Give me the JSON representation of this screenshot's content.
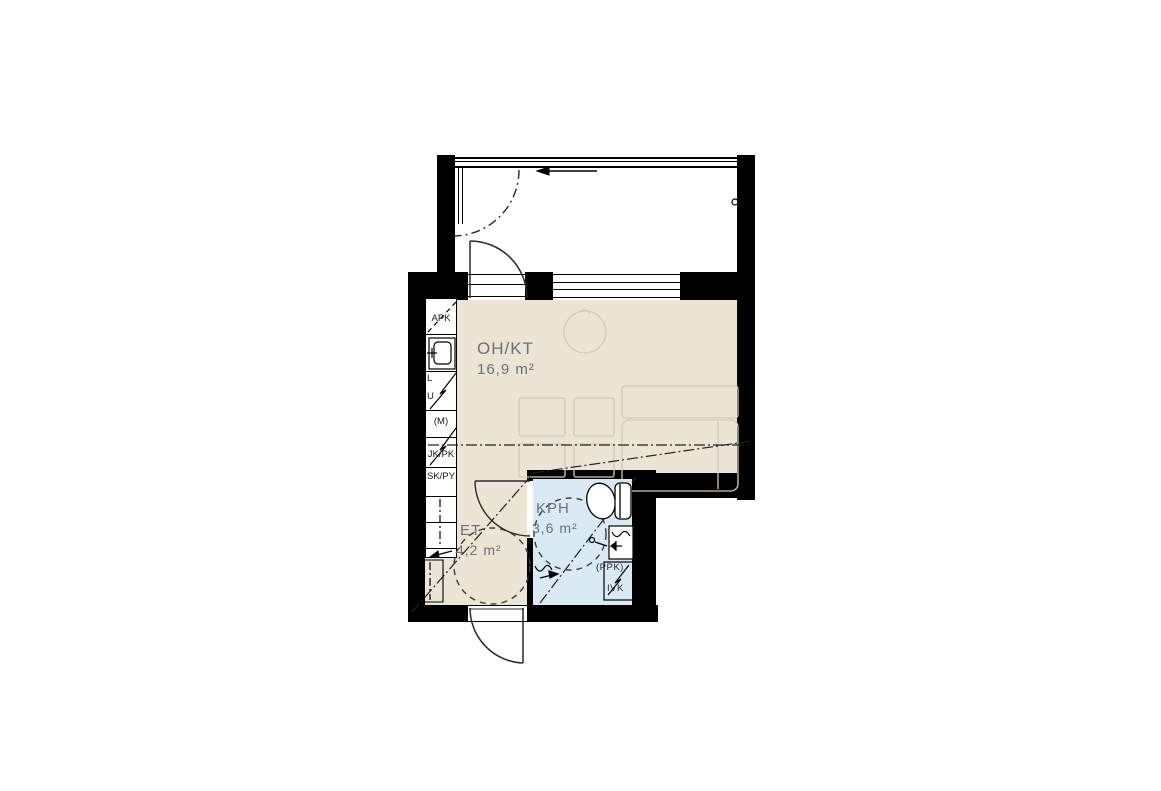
{
  "plan_title": "apartment-floor-plan",
  "rooms": [
    {
      "label": "OH/KT",
      "area": "16,9 m²"
    },
    {
      "label": "ET",
      "area": "4,2 m²"
    },
    {
      "label": "KPH",
      "area": "3,6 m²"
    }
  ],
  "kitchen_labels": {
    "apk": "APK",
    "stove_l": "L",
    "stove_u": "U",
    "micro": "(M)",
    "fridge": "JK/PK",
    "closet": "SK/PY"
  },
  "bathroom_labels": {
    "washer": "(PPK)",
    "vent": "IVK"
  },
  "symbols": [
    "toilet-icon",
    "washbasin-icon",
    "shower-icon",
    "kitchen-sink-icon",
    "door-swing-arc",
    "sliding-glazing-arc",
    "direction-arrow-icon",
    "turning-circle",
    "duct-dashdot-line",
    "reservation-zigzag"
  ],
  "colors": {
    "wall": "#000000",
    "floor_living": "#ece4d5",
    "floor_bath": "#d9eaf5",
    "floor_balcony": "#ffffff",
    "furniture_outline": "#d5cab8",
    "room_label": "#6b7076"
  }
}
